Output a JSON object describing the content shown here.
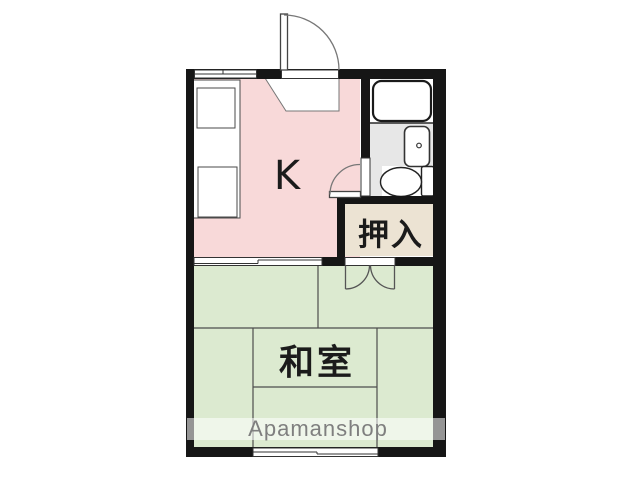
{
  "plan": {
    "title": "1K apartment floor plan",
    "rooms": {
      "kitchen": {
        "label": "K"
      },
      "washitsu": {
        "label": "和室"
      },
      "closet": {
        "label": "押入"
      }
    },
    "fixtures": [
      "bathtub",
      "washbasin",
      "toilet",
      "kitchen-counter"
    ],
    "watermark": {
      "text": "Apamanshop"
    }
  },
  "colors": {
    "kitchen": "#f8d9d9",
    "washitsu": "#dcead0",
    "closet": "#ece3d3",
    "bath-floor": "#e7e7e7",
    "wall": "#161616",
    "tatami-line": "#4d4d4d",
    "fixture-line": "#2a2a2a",
    "watermark-text": "#7f7f7f"
  }
}
